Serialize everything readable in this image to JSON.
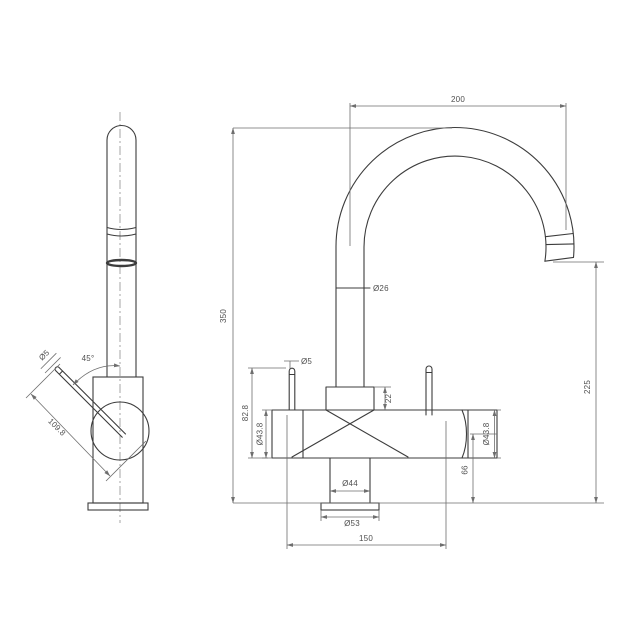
{
  "page": {
    "title": "Kitchen mixer tap technical drawing",
    "background": "#ffffff"
  },
  "colors": {
    "object_line": "#3c3c3c",
    "dimension_line": "#6e6e6e",
    "centerline": "#8f8f8f",
    "text": "#4f4f4f"
  },
  "labels": {
    "side_view": {
      "lever_diameter": "Ø5",
      "lever_angle": "45°",
      "lever_length": "109.8"
    },
    "front_view": {
      "spout_reach": "200",
      "total_height": "350",
      "spout_tube_diameter": "Ø26",
      "outlet_height": "225",
      "pin_diameter": "Ø5",
      "pin_top_height": "82.8",
      "left_body_diameter": "Ø43.8",
      "neck_height": "22",
      "right_body_diameter": "Ø43.8",
      "side_body_height": "66",
      "column_diameter": "Ø44",
      "base_diameter": "Ø53",
      "handle_spread": "150"
    }
  }
}
